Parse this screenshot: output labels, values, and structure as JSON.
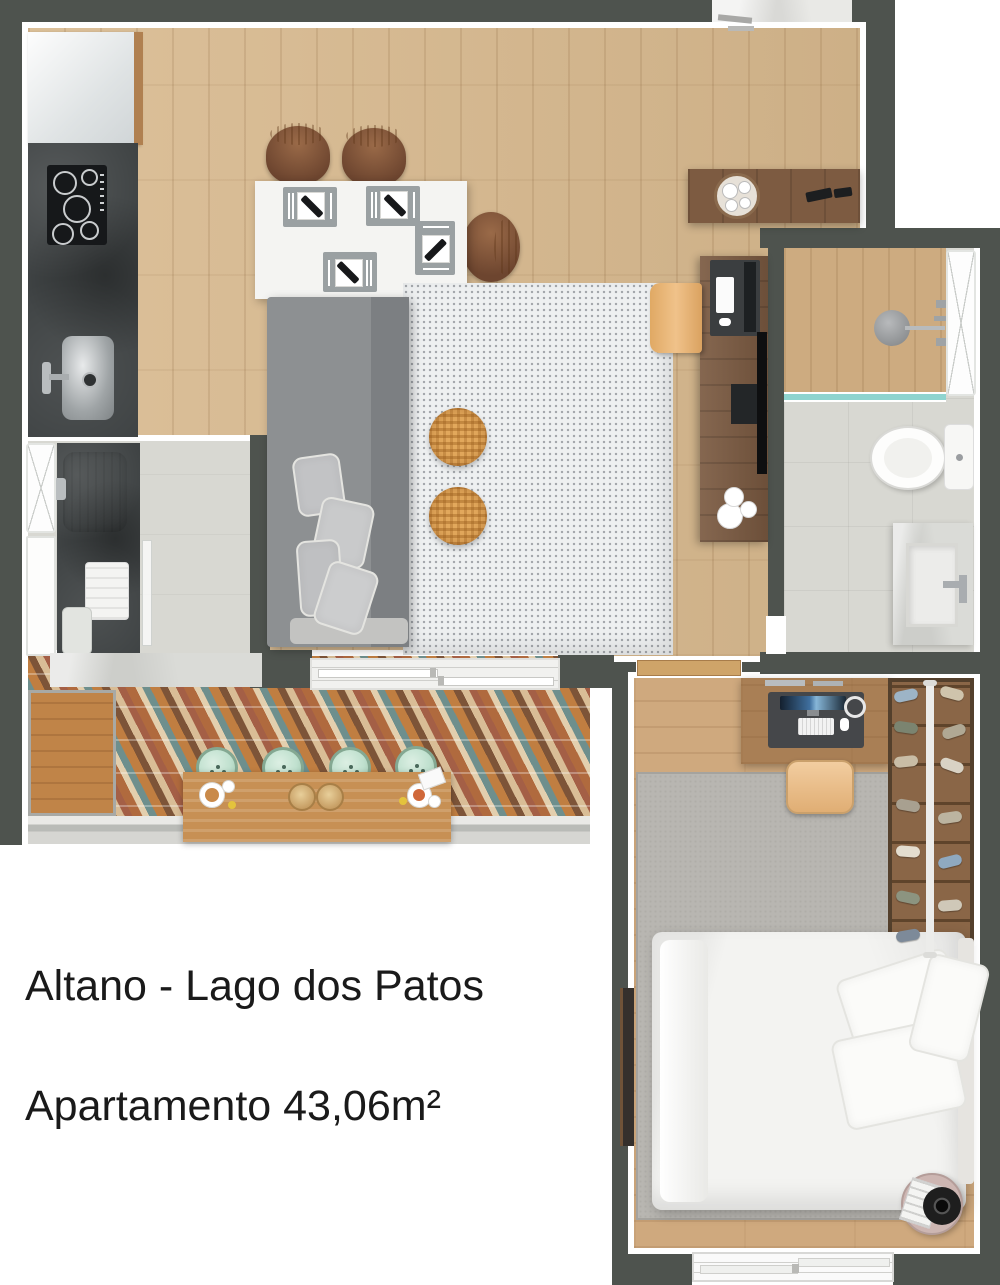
{
  "title": {
    "line1": "Altano - Lago dos Patos",
    "line2": "Apartamento 43,06m²"
  },
  "palette": {
    "wall": "#4e534e",
    "floor-wood": "#d8b98e",
    "bedroom-wood": "#cfa97e",
    "desk-wood": "#7b5a41",
    "counter-wood": "#c79054",
    "stone": "#3f4344",
    "tile": "#d8d8d2",
    "rug": "#eef0f1",
    "bedroom-rug": "#b8b6b1",
    "sofa": "#8d9092",
    "pouf": "#e2a85c",
    "glass": "#8fd4cf",
    "stool": "#bfe0ce",
    "text": "#1a1a1a"
  }
}
